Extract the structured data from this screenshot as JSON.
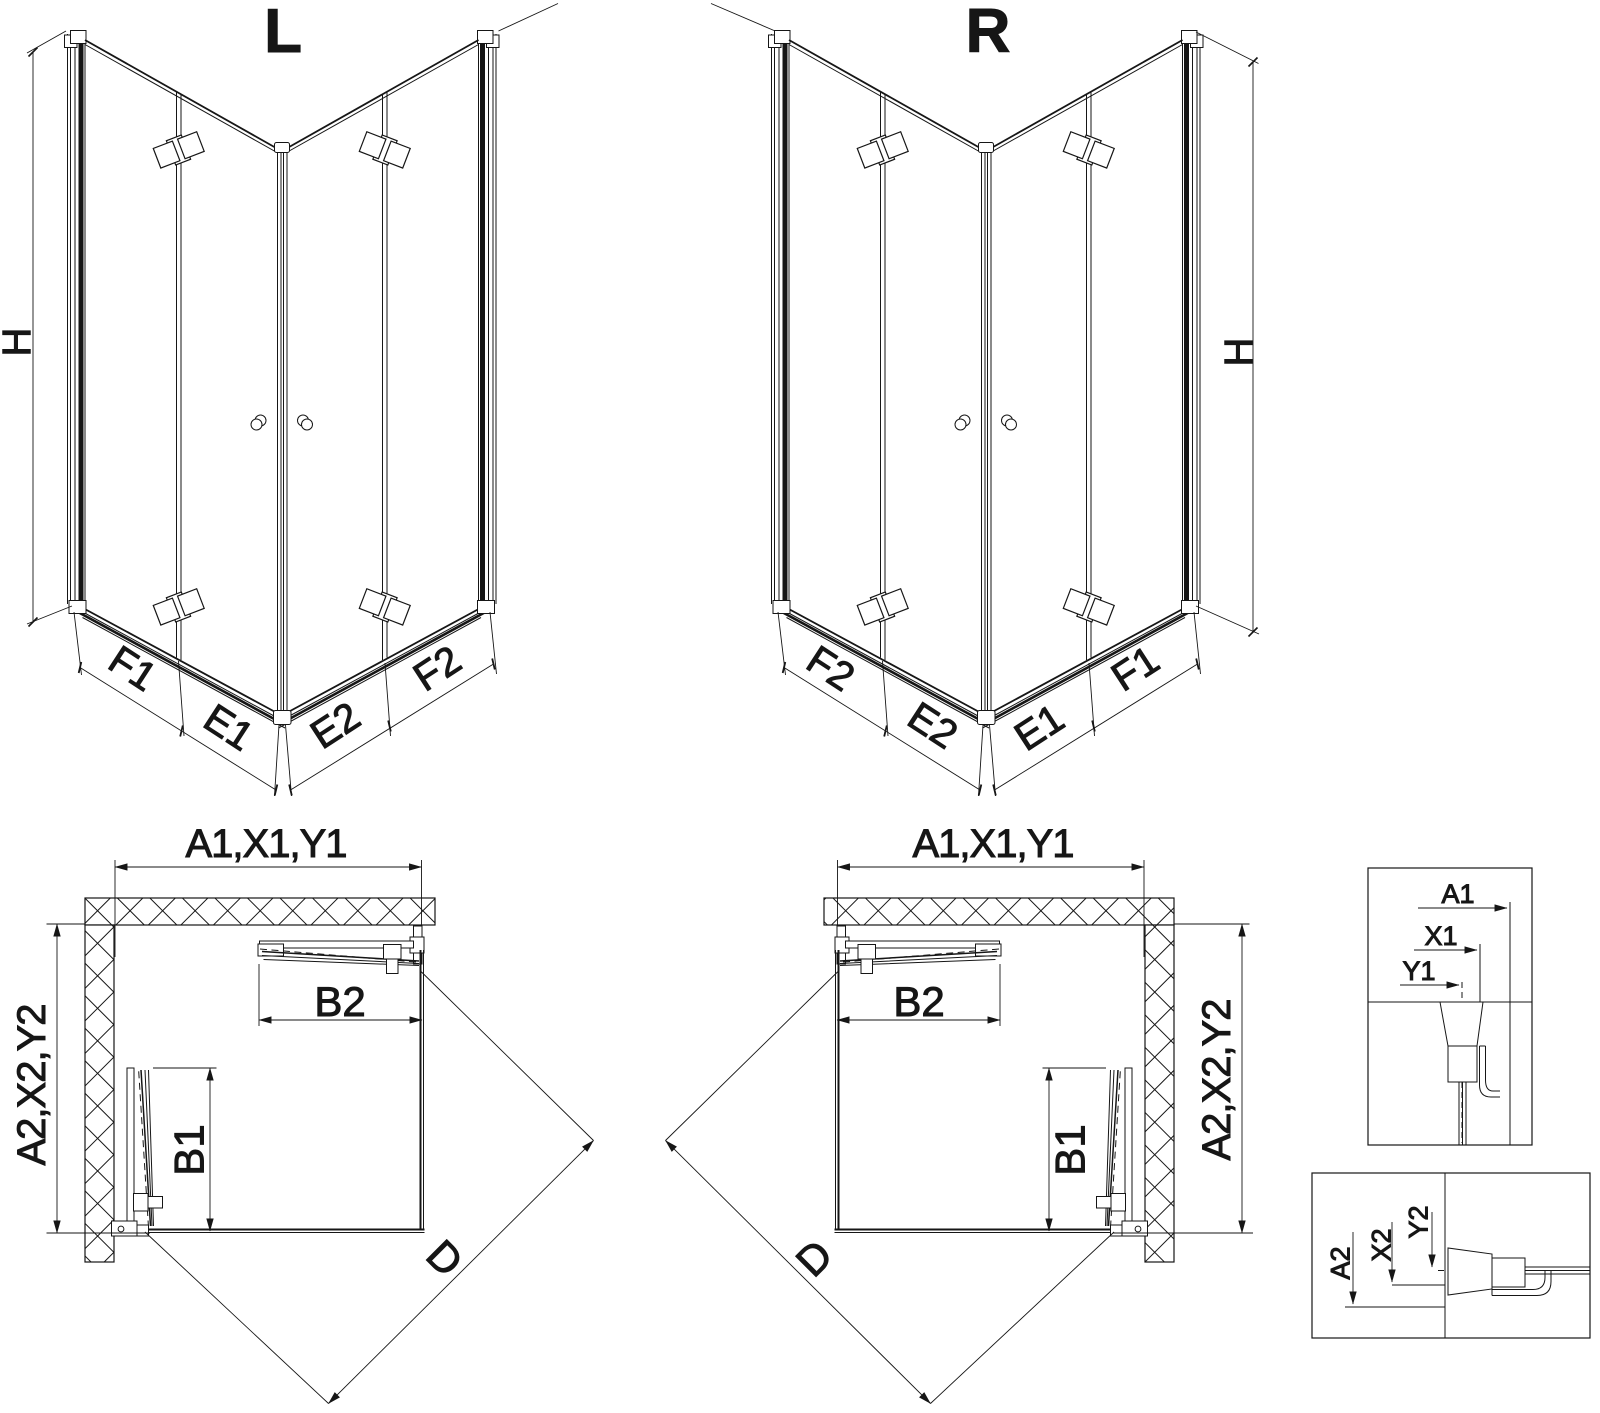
{
  "views": {
    "persp_left": {
      "title": "L",
      "h": "H",
      "f1": "F1",
      "e1": "E1",
      "e2": "E2",
      "f2": "F2"
    },
    "persp_right": {
      "title": "R",
      "h": "H",
      "f1": "F1",
      "e1": "E1",
      "e2": "E2",
      "f2": "F2"
    },
    "plan_left": {
      "width_label": "A1,X1,Y1",
      "depth_label": "A2,X2,Y2",
      "b2": "B2",
      "b1": "B1",
      "d": "D"
    },
    "plan_right": {
      "width_label": "A1,X1,Y1",
      "depth_label": "A2,X2,Y2",
      "b2": "B2",
      "b1": "B1",
      "d": "D"
    },
    "detail_top": {
      "a1": "A1",
      "x1": "X1",
      "y1": "Y1"
    },
    "detail_bottom": {
      "a2": "A2",
      "x2": "X2",
      "y2": "Y2"
    }
  },
  "colors": {
    "line": "#161616",
    "background": "#ffffff"
  }
}
